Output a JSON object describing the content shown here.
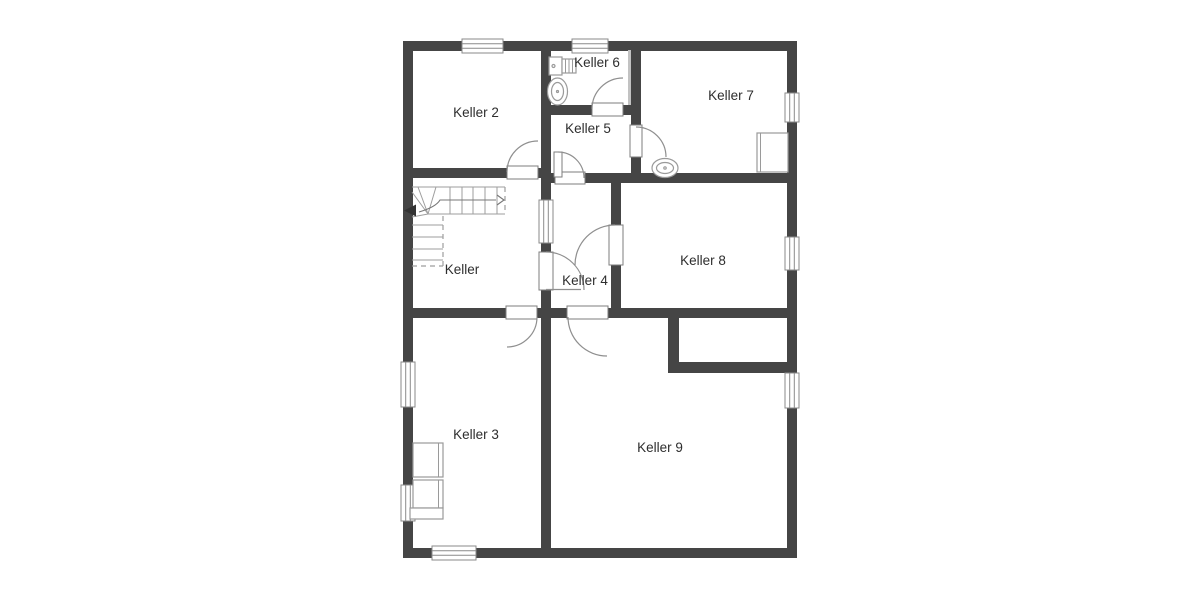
{
  "plan": {
    "type": "floor-plan",
    "floor": "basement",
    "background": "#ffffff",
    "wall_color": "#454545",
    "label_color": "#2e2e2e",
    "fixture_line_color": "#9a9a9a",
    "rooms": [
      {
        "id": "keller-2",
        "label": "Keller 2"
      },
      {
        "id": "keller-6",
        "label": "Keller 6"
      },
      {
        "id": "keller-7",
        "label": "Keller 7"
      },
      {
        "id": "keller-5",
        "label": "Keller 5"
      },
      {
        "id": "keller",
        "label": "Keller"
      },
      {
        "id": "keller-4",
        "label": "Keller 4"
      },
      {
        "id": "keller-8",
        "label": "Keller 8"
      },
      {
        "id": "keller-3",
        "label": "Keller 3"
      },
      {
        "id": "keller-9",
        "label": "Keller 9"
      }
    ]
  }
}
